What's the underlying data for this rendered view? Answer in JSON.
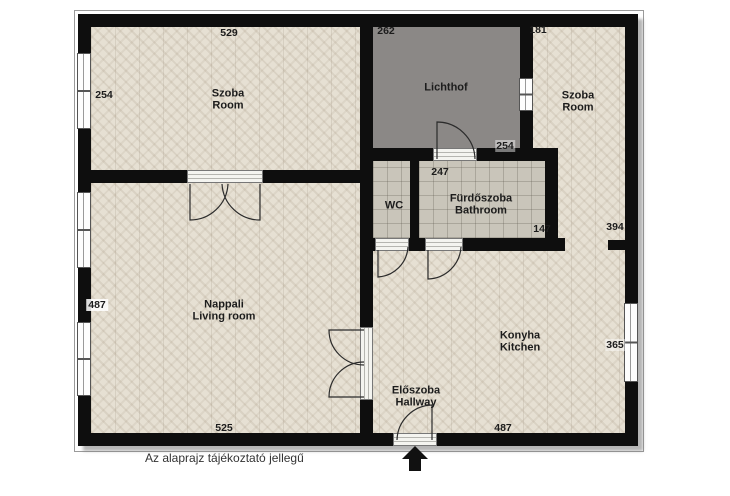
{
  "disclaimer": "Az alaprajz tájékoztató jellegű",
  "rooms": {
    "szoba_left": {
      "name": "Szoba",
      "name_en": "Room"
    },
    "lichthof": {
      "name": "Lichthof"
    },
    "szoba_right": {
      "name": "Szoba",
      "name_en": "Room"
    },
    "wc": {
      "name": "WC"
    },
    "bathroom": {
      "name": "Fürdőszoba",
      "name_en": "Bathroom"
    },
    "living_room": {
      "name": "Nappali",
      "name_en": "Living room"
    },
    "kitchen": {
      "name": "Konyha",
      "name_en": "Kitchen"
    },
    "hallway": {
      "name": "Előszoba",
      "name_en": "Hallway"
    }
  },
  "dimensions_cm": {
    "szoba_left_width": "529",
    "szoba_left_height": "254",
    "lichthof_width": "262",
    "lichthof_height": "254",
    "szoba_right_width": "181",
    "szoba_right_height": "394",
    "bathroom_width": "247",
    "bathroom_height": "147",
    "living_height": "487",
    "living_width": "525",
    "kitchen_height": "365",
    "kitchen_width": "487"
  },
  "entrance": {
    "direction": "up"
  },
  "colors": {
    "wall": "#0e0e0e",
    "parquet": "#e6e0d3",
    "tile": "#c9c5ba",
    "lichthof": "#8b8886",
    "background": "#ffffff"
  }
}
